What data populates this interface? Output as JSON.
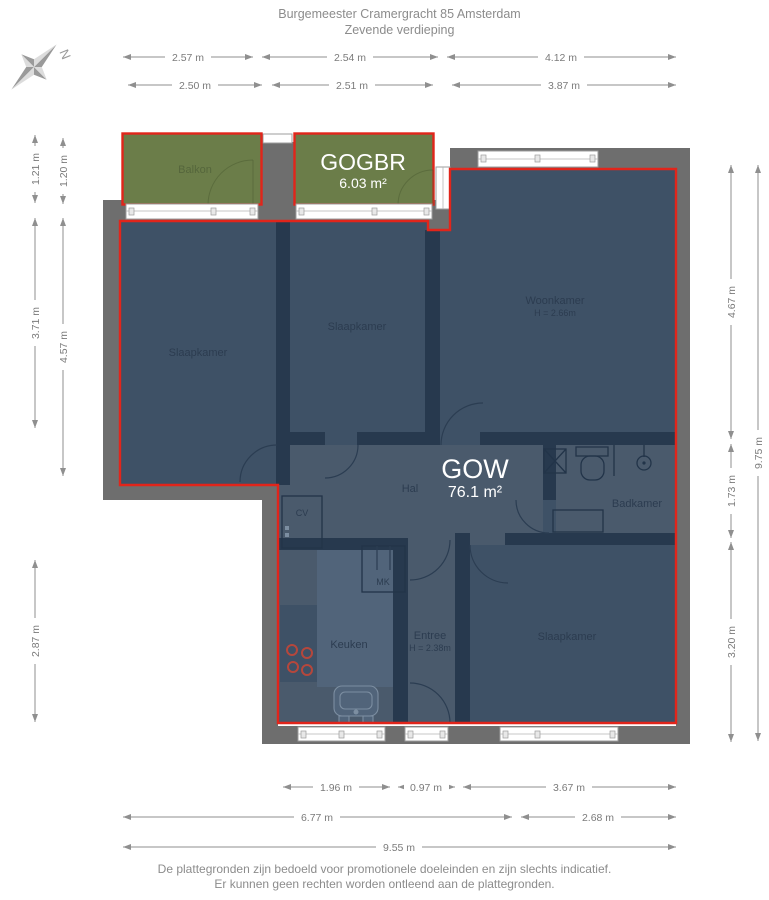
{
  "header": {
    "line1": "Burgemeester Cramergracht 85 Amsterdam",
    "line2": "Zevende verdieping"
  },
  "compass": {
    "label": "N"
  },
  "rooms": {
    "balkon": "Balkon",
    "gogbr": {
      "name": "GOGBR",
      "area": "6.03 m²"
    },
    "slaapkamer1": "Slaapkamer",
    "slaapkamer2": "Slaapkamer",
    "woonkamer": {
      "name": "Woonkamer",
      "height": "H = 2.66m"
    },
    "hal": "Hal",
    "gow": {
      "name": "GOW",
      "area": "76.1 m²"
    },
    "badkamer": "Badkamer",
    "cv": "CV",
    "mk": "MK",
    "keuken": "Keuken",
    "entree": {
      "name": "Entree",
      "height": "H = 2.38m"
    },
    "slaapkamer3": "Slaapkamer"
  },
  "dimensions": {
    "top_row1": [
      "2.57 m",
      "2.54 m",
      "4.12 m"
    ],
    "top_row2": [
      "2.50 m",
      "2.51 m",
      "3.87 m"
    ],
    "left_outer": [
      "1.21 m",
      "3.71 m",
      "2.87 m"
    ],
    "left_inner": [
      "1.20 m",
      "4.57 m"
    ],
    "right_inner": [
      "4.67 m",
      "1.73 m",
      "3.20 m"
    ],
    "right_outer": [
      "9.75 m"
    ],
    "bottom_row1": [
      "1.96 m",
      "0.97 m",
      "3.67 m"
    ],
    "bottom_row2": [
      "6.77 m",
      "2.68 m"
    ],
    "bottom_row3": [
      "9.55 m"
    ]
  },
  "footer": {
    "line1": "De plattegronden zijn bedoeld voor promotionele doeleinden en zijn slechts indicatief.",
    "line2": "Er kunnen geen rechten worden ontleend aan de plattegronden."
  },
  "colors": {
    "outline_red": "#e1251b",
    "balcony_green": "#6b7d49",
    "floor_blue": "#3e5166",
    "wall_gray": "#6e6e6e"
  }
}
